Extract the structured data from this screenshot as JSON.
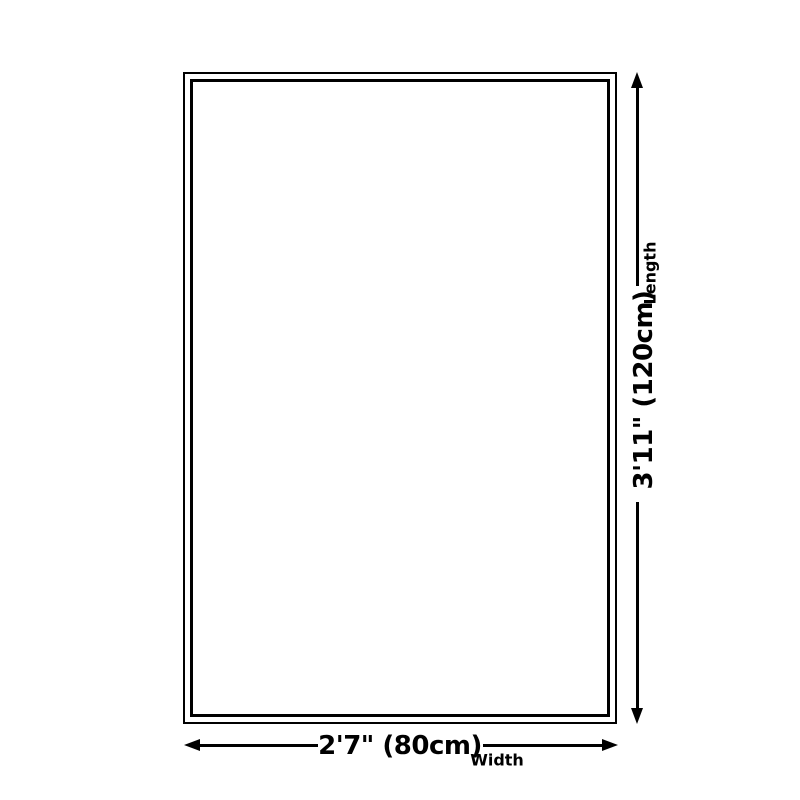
{
  "diagram": {
    "type": "product-size-diagram",
    "background_color": "#ffffff",
    "line_color": "#000000",
    "dimensions": {
      "length": {
        "value": "3'11\" (120cm)",
        "label": "Length"
      },
      "width": {
        "value": "2'7\" (80cm)",
        "label": "Width"
      }
    }
  }
}
